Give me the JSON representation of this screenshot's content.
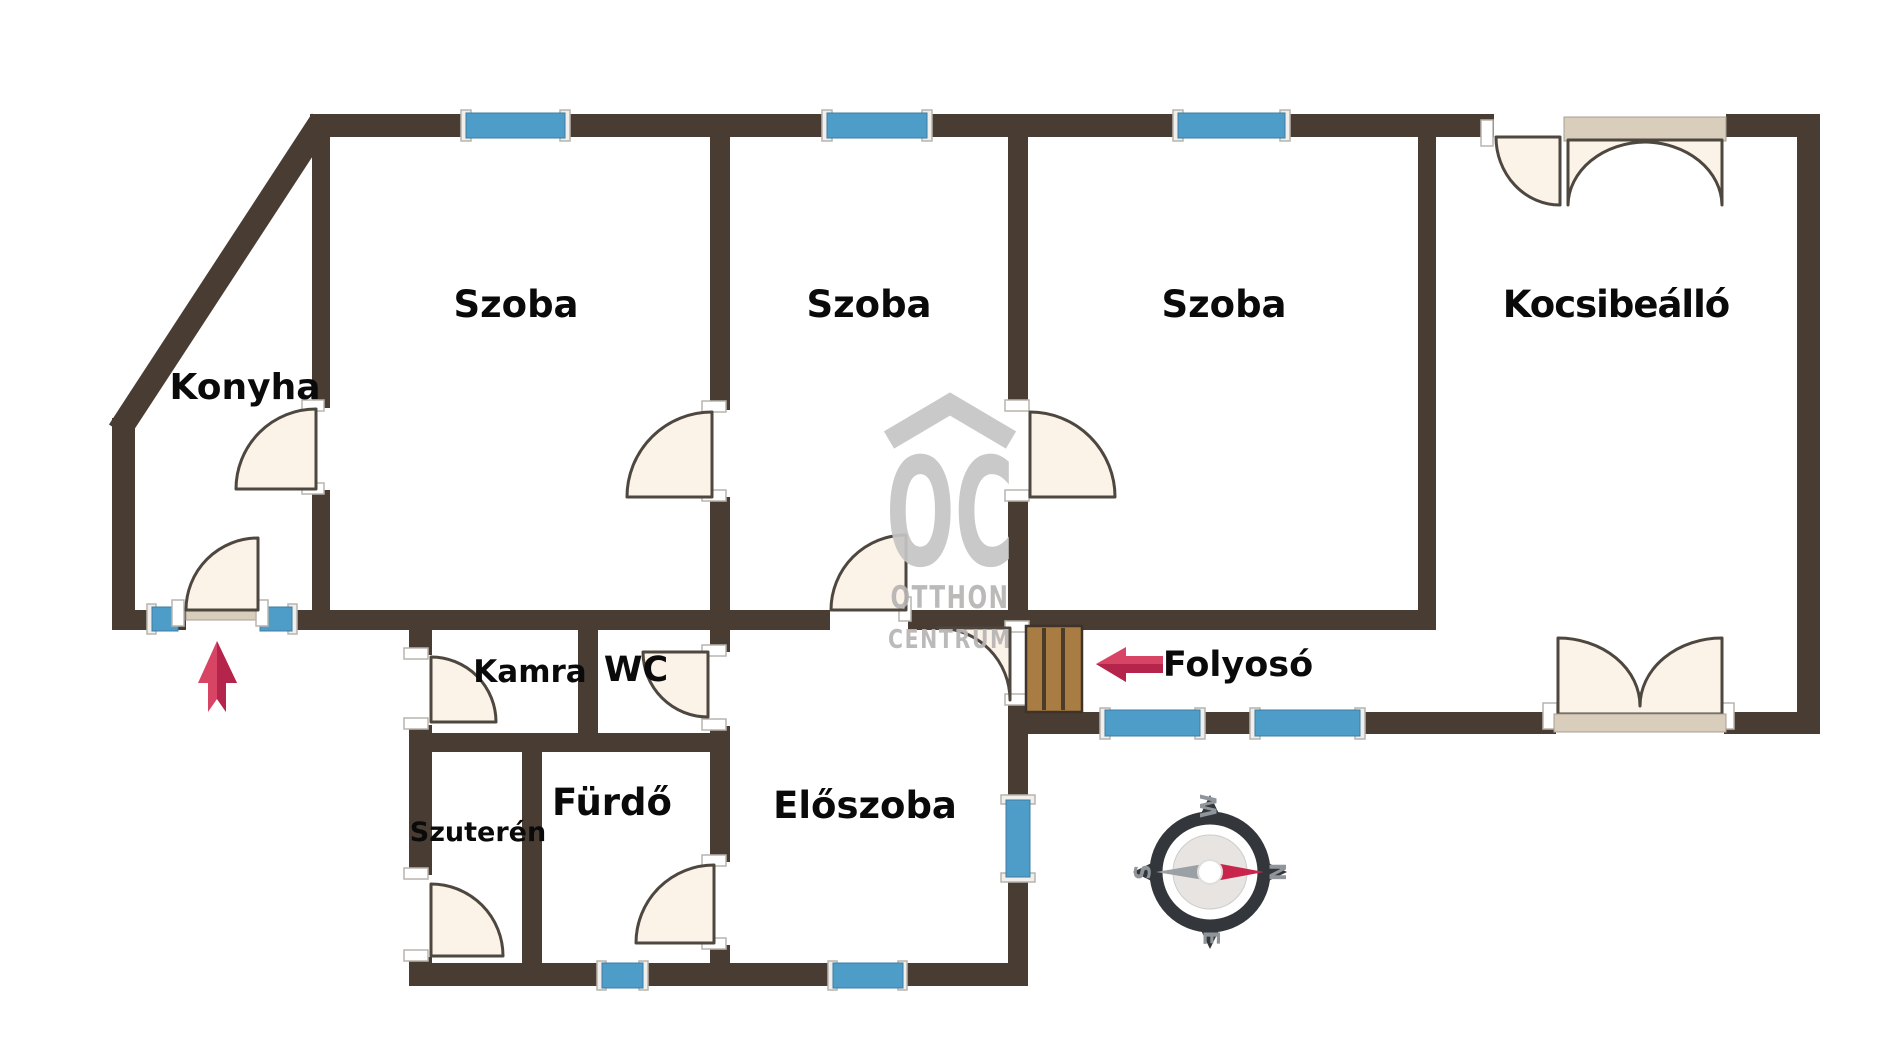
{
  "labels": {
    "konyha": "Konyha",
    "szoba1": "Szoba",
    "szoba2": "Szoba",
    "szoba3": "Szoba",
    "kocsibeallo": "Kocsibeálló",
    "kamra": "Kamra",
    "wc": "WC",
    "szuteren": "Szuterén",
    "furdo": "Fürdő",
    "eloszoba": "Előszoba",
    "folyoso": "Folyosó"
  },
  "watermark": {
    "initials": "OC",
    "line1": "OTTHON",
    "line2": "CENTRUM"
  },
  "compass": {
    "north": "N",
    "south": "S",
    "west": "W",
    "east": "E"
  },
  "colors": {
    "wall": "#483C33",
    "window_blue": "#4E9CC8",
    "window_frame": "#F0EFEC",
    "door_fill": "#FBF3E7",
    "door_stroke": "#4D473F",
    "sill_tan": "#D9CDBC",
    "wood": "#A87C42",
    "wood_line": "#4B3B28",
    "arrow_red": "#D84463",
    "arrow_red_dark": "#B5244A",
    "watermark_gray": "#C6C5C5",
    "watermark_text": "#B7B4B4",
    "label_black": "#0A0A0A",
    "compass_dark": "#33373C",
    "compass_gray": "#8F959B",
    "needle_gray": "#9AA0A4",
    "needle_red": "#C9244B"
  }
}
